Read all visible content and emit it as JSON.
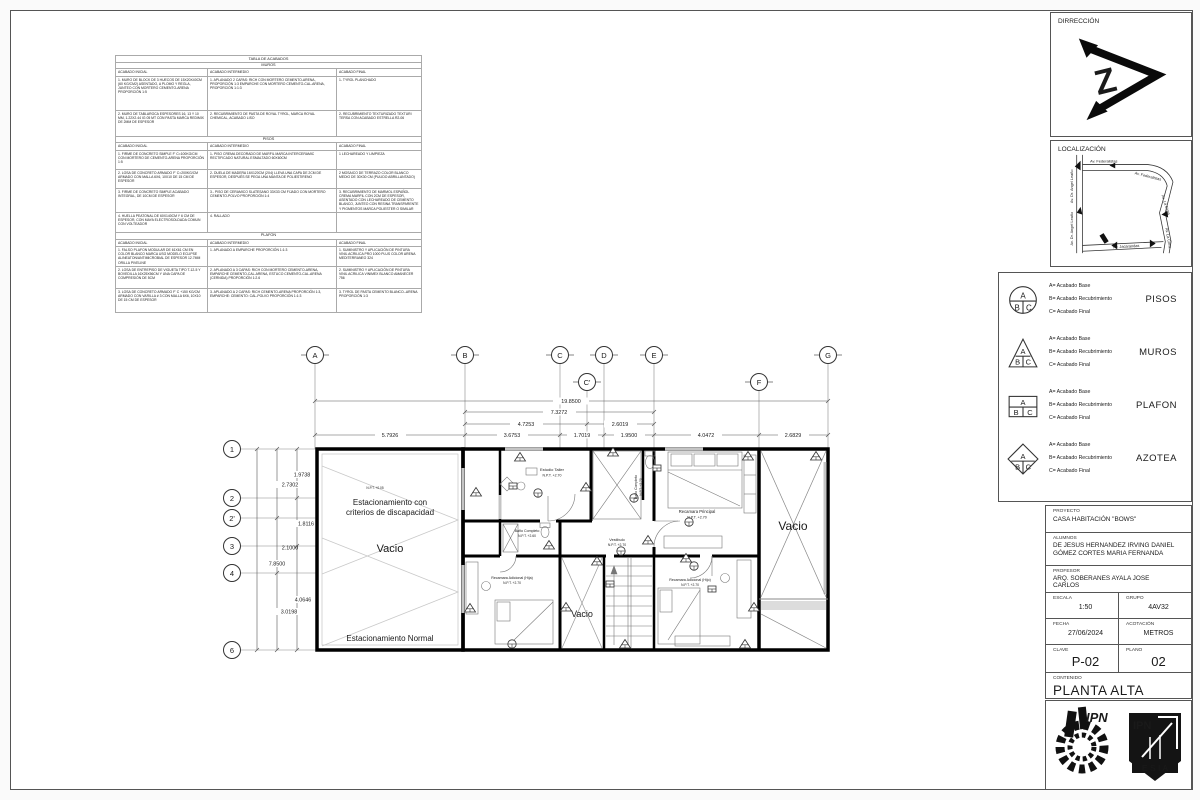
{
  "acabados": {
    "title": "TABLA DE ACABADOS",
    "headers": [
      "ACABADO INICIAL",
      "ACABADO INTERMEDIO",
      "ACABADO FINAL"
    ],
    "muros": {
      "name": "MUROS",
      "rows": [
        {
          "i": "1. MURO DE BLOCK DE 3 HUECOS DE 15X20X40CM (60 KG/CM2) ASENTADO, A PLOMO Y REGLA, JUNTEO CON MORTERO CEMENTO-ARENA PROPORCIÓN 1:5",
          "m": "1. APLANADO 2 CAPAS: RICH CON MORTERO CEMENTO-ARENA, PROPORCIÓN 1:3 EMPARCHE CON MORTERO CEMENTO-CAL-ARENA, PROPORCIÓN 1:1:3",
          "f": "1- TYROL PLANCHADO"
        },
        {
          "i": "2. MURO DE TABLAROCA ESPESORES 16, 13 Y 10 MM, 1.22X2.44 IG 05 MT CON PASTA MARCA REDIMIX DE 2MM DE ESPESOR",
          "m": "2. RECUBRIMIENTO DE PASTA DE ROYAL TYROL, MARCA ROYAL CHEMICAL, ACABADO LISO",
          "f": "2- RECUBRIMIENTO TEXTURIZADO TEXTURI TERSA CON ACABADO ESTRELLA R2-06"
        }
      ]
    },
    "pisos": {
      "name": "PISOS",
      "rows": [
        {
          "i": "1. FIRME DE CONCRETO SIMPLE F' C=100KG/CM CON MORTERO DE CEMENTO-ARENA PROPORCIÓN 1:5",
          "m": "1- PISO CREMA DECORADO DE MARFIL MARCA INTERCERAMIC RECTIFICADO NATURAL ESMALTADO 60X60CM",
          "f": "1 LECHAREADO Y LIMPIEZA"
        },
        {
          "i": "2. LOSA DE CONCRETO ARMADO F' C=200KG/CM ARMADO CON MALLA 6X6, 10X10 DE 15 CM DE ESPESOR",
          "m": "2- DUELA DE MADERA 16X120CM (2X4) LLEVA UNA CAPA DE 2CM DE ESPESOR, DESPUÉS SE PEGA UNA MANTA DE POLIESTIRENO",
          "f": "2 MOSAICO DE TERRAZO COLOR BLANCO MEDIO DE 30X30 CM (PULIDO ABRILLANTADO)"
        },
        {
          "i": "3. FIRME DE CONCRETO SIMPLE ACABADO INTEGRAL, DE 10CM DE ESPESOR",
          "m": "3.- PISO DE CERAMICO SLATESANO 33X33 CM FIJADO CON MORTERO CEMENTO-POLVO PROPORCIÓN 1:4",
          "f": "3. RECUBRIMIENTO DE MARMOL ESPAÑOL CREMA MARFIL CON 2CM DE ESPESOR, ASENTADO CON LECHAREADO DE CEMENTO BLANCO, JUNTEO CON RESINA TRANSPARENTE Y PIGMENTOS MARCA POLIESTER O SIMILAR"
        },
        {
          "i": "4. HUELLA PEATONAL DE 60X140CM Y 6 CM DE ESPESOR, CON MAYA ELECTROSOLDADA COMUN CON VOLTEADOR",
          "m": "4. RALLADO",
          "f": ""
        }
      ]
    },
    "plafon": {
      "name": "PLAFON",
      "rows": [
        {
          "i": "1. FALSO PLAFON MODULAR DE 61X61 CM EN COLOR BLANCO MARCA USG MODELO ECLIPSE ALINEATON/ANTIMICROBIAL DE ESPESOR 12.7MM ORILLA PIVELINE",
          "m": "1. APLANADO A EMPARCHE PROPORCIÓN 1:1:3",
          "f": "1. SUMINISTRO Y APLICACIÓN DE PINTURA VINIL ACRILICA PRO 1000 PLUS COLOR ARENA MEDITERRANEO 324"
        },
        {
          "i": "2. LOSA DE ENTREPISO DE VIGUETA TIPO T-12-5 Y BOVEDILLA 16X25X56CM Y UNA CAPA DE COMPRESIÓN DE 5CM",
          "m": "2. APLANADO A 3 CAPAS: RICH CON MORTERO CEMENTO-ARENA, EMPARCHE CEMENTO-CAL-ARENA, ESTUCO CEMENTO-CAL-ARENA (CERNIDA) PROPORCIÓN 1:2.6",
          "f": "2. SUMINISTRO Y APLICACIÓN DE PINTURA VINIL ACRILICA VINIMEX BLANCO AMANECER 756"
        },
        {
          "i": "3. LOSA DE CONCRETO ARMADO F' C +150 KG/CM ARMADO CON VARILLA # 3 CON MALLA 6X6, 10X10 DE 15 CM DE ESPESOR",
          "m": "3. APLANADO A 2 CAPAS: RICH CEMENTO-ARENA PROPORCIÓN 1:3, EMPARCHE: CEMENTO: CAL-POLVO PROPORCIÓN 1:1:3",
          "f": "3. TYROL DE PASTA CEMENTO BLANCO--ARENA PROPORCIÓN 1:3"
        }
      ]
    }
  },
  "titleblock": {
    "dirreccion": "DIRRECCIÓN",
    "localizacion": "LOCALIZACIÓN",
    "proyecto_label": "PROYECTO",
    "proyecto": "CASA HABITACIÓN \"BOWS\"",
    "alumnos_label": "ALUMNOS",
    "alumno1": "DE JESUS HERNANDEZ IRVING DANIEL",
    "alumno2": "GÓMEZ CORTES MARIA FERNANDA",
    "profesor_label": "PROFESOR",
    "profesor": "ARQ. SOBERANES AYALA JOSE CARLOS",
    "escala_label": "ESCALA",
    "escala": "1:50",
    "grupo_label": "GRUPO",
    "grupo": "4AV32",
    "fecha_label": "FECHA",
    "fecha": "27/06/2024",
    "acotacion_label": "ACOTACIÓN",
    "acotacion": "METROS",
    "clave_label": "CLAVE",
    "clave": "P-02",
    "plano_label": "PLANO",
    "plano": "02",
    "contenido_label": "CONTENIDO",
    "contenido": "PLANTA ALTA"
  },
  "legend": {
    "letters": {
      "a": "A",
      "b": "B",
      "c": "C"
    },
    "line_a": "A= Acabado Base",
    "line_b": "B= Acabado Recubrimiento",
    "line_c": "C= Acabado Final",
    "names": [
      "PISOS",
      "MUROS",
      "PLAFON",
      "AZOTEA"
    ]
  },
  "map": {
    "fed1": "Av. Federalistas",
    "fed2": "Av. Federalistas",
    "angel1": "Av. Dr. Angel Leaño",
    "angel2": "Av. Dr. Angel Leaño",
    "cima1": "Av. La Cima",
    "cima2": "Av. La Cima",
    "bottom": "Av. Jacarandas"
  },
  "logos": {
    "ipn": "IPN",
    "esia_ipn": "IPN",
    "esia": "E S I A"
  },
  "plan": {
    "axes_top": [
      "A",
      "B",
      "C",
      "D",
      "E",
      "G"
    ],
    "axes_mid": [
      "C'",
      "F"
    ],
    "axes_left": [
      "1",
      "2",
      "2'",
      "3",
      "4",
      "6"
    ],
    "dims_top": [
      "19.8500",
      "7.3272",
      "4.7253",
      "2.6019"
    ],
    "dims_bottom": [
      "5.7926",
      "3.6753",
      "1.7019",
      "1.9500",
      "4.0472",
      "2.6829"
    ],
    "dims_left": [
      "1.9738",
      "2.7302",
      "1.8116",
      "2.1000",
      "7.8500",
      "4.0646",
      "3.0198"
    ],
    "rooms": {
      "parking_npt": "N.P.T. +0.05",
      "parking_disabled_1": "Estacionamiento con",
      "parking_disabled_2": "criterios de discapacidad",
      "parking_vacio": "Vacio",
      "parking_normal": "Estacionamiento Normal",
      "estudio": "Estudio Taller",
      "estudio_npt": "N.P.T. +2.70",
      "bano2": "Baño Completo",
      "bano2_npt": "N.P.T. +2.70",
      "bano1": "Baño Completo",
      "bano1_npt": "N.P.T. +2.60",
      "principal": "Recamara Principal",
      "principal_npt": "N.P.T. +2.70",
      "vestibulo": "Vestibulo",
      "vestibulo_npt": "N.P.T. +2.70",
      "hija": "Recamara Adicional (Hija)",
      "hija_npt": "N.P.T. +2.70",
      "vacio_small": "Vacio",
      "hijo": "Recamara Adicional (Hijo)",
      "hijo_npt": "N.P.T. +2.70",
      "vacio_big": "Vacio"
    }
  }
}
